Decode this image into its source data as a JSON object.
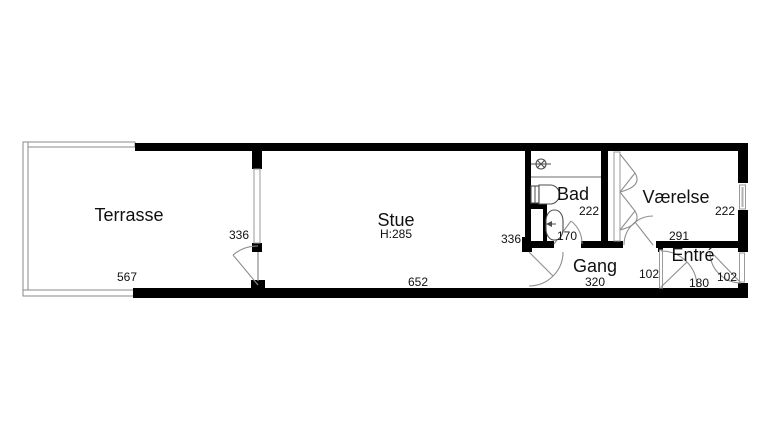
{
  "plan": {
    "title": "apartment-floorplan",
    "rooms": {
      "terrasse": {
        "label": "Terrasse"
      },
      "stue": {
        "label": "Stue",
        "ceiling_height": "H:285"
      },
      "bad": {
        "label": "Bad"
      },
      "vaerelse": {
        "label": "Værelse"
      },
      "gang": {
        "label": "Gang"
      },
      "entre": {
        "label": "Entré"
      }
    },
    "dimensions": {
      "terrasse_width": "567",
      "stue_depth_west": "336",
      "stue_length": "652",
      "stue_depth_east": "336",
      "bad_width": "170",
      "bad_depth": "222",
      "vaerelse_width": "291",
      "vaerelse_depth": "222",
      "gang_length": "320",
      "gang_width": "102",
      "entre_width": "180",
      "entre_door_width": "102"
    },
    "colors": {
      "wall": "#000000",
      "thin_line": "#8a8a8a",
      "background": "#ffffff",
      "text": "#111111"
    }
  }
}
